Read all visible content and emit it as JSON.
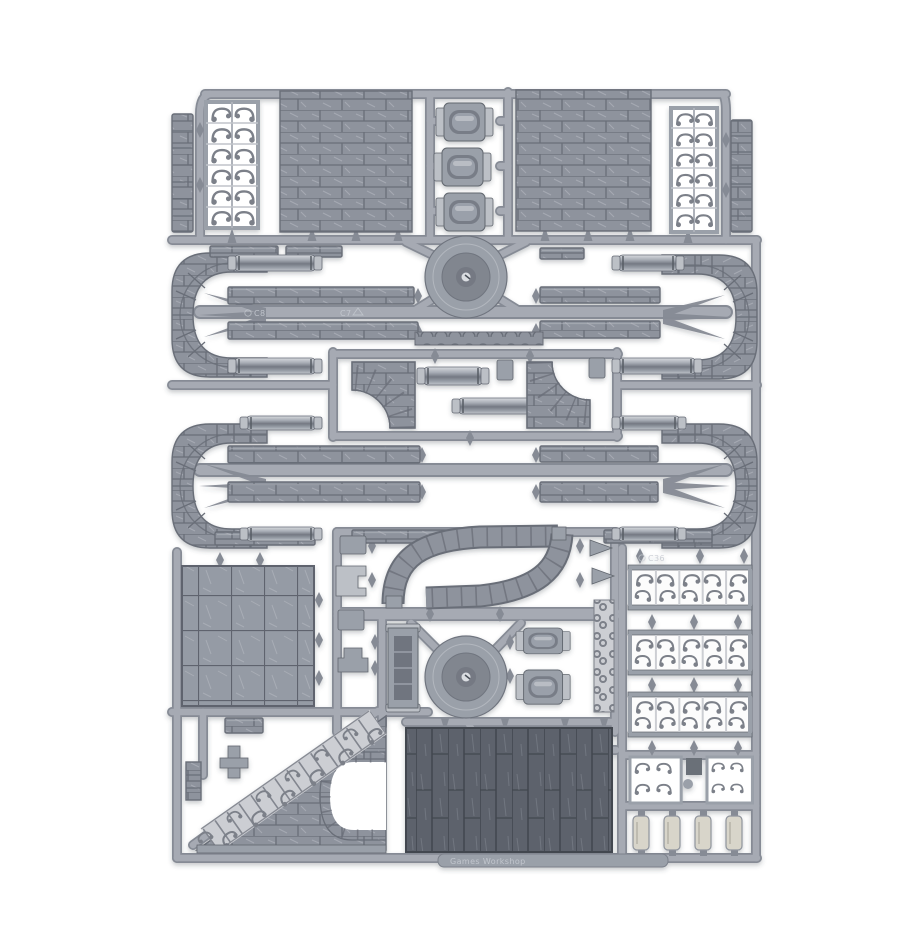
{
  "meta": {
    "title": "Plastic terrain sprue - product photo",
    "alt": "Product photo of a grey plastic model sprue containing modular walkway terrain pieces, ornate railings, stone wall and floor panels, photographed on a plain white background"
  },
  "photo": {
    "background_color": "#ffffff",
    "subject": "injection-moulded plastic sprue (frame) of unassembled miniature terrain parts",
    "material": "light grey polystyrene plastic"
  },
  "palette": {
    "background": "#ffffff",
    "runner": "#a6aab3",
    "runner-dark": "#868b95",
    "part-light": "#bcc0c6",
    "part-mid": "#9aa0a9",
    "brick-face": "#8e939d",
    "brick-line": "#696e78",
    "brick-hi": "#b7bbc2",
    "tile-face": "#959ba5",
    "tile-line": "#5f646e",
    "plank-dark": "#5d626c",
    "plank-line": "#42474f",
    "filigree-dark": "#7b8089",
    "filigree-light": "#ccced3",
    "hub-face": "#9aa0a9",
    "hub-inner": "#81868f",
    "cream": "#d8d5ca"
  },
  "markings": {
    "code_1": "C8",
    "code_2": "C7",
    "code_3": "C36",
    "runner_text": "Games Workshop"
  },
  "parts_inventory": [
    {
      "name": "stone wall panel",
      "count": 2
    },
    {
      "name": "ornate railing panel vertical",
      "count": 2
    },
    {
      "name": "ornate railing panel horizontal",
      "count": 3
    },
    {
      "name": "stone pillar strip",
      "count": 2
    },
    {
      "name": "lantern pipe segment",
      "count": 5
    },
    {
      "name": "curved walkway end section",
      "count": 4
    },
    {
      "name": "straight walkway plank",
      "count": 8
    },
    {
      "name": "handrail tube",
      "count": 10
    },
    {
      "name": "round hub base",
      "count": 2
    },
    {
      "name": "curved ramp section",
      "count": 4
    },
    {
      "name": "stone tile floor panel",
      "count": 1
    },
    {
      "name": "plank floor panel",
      "count": 1
    },
    {
      "name": "staircase with ornate balustrade",
      "count": 1
    },
    {
      "name": "arched walkway section",
      "count": 1
    },
    {
      "name": "ornate corner bracket",
      "count": 2
    },
    {
      "name": "step bracket",
      "count": 4
    },
    {
      "name": "small connector clip",
      "count": 6
    }
  ]
}
